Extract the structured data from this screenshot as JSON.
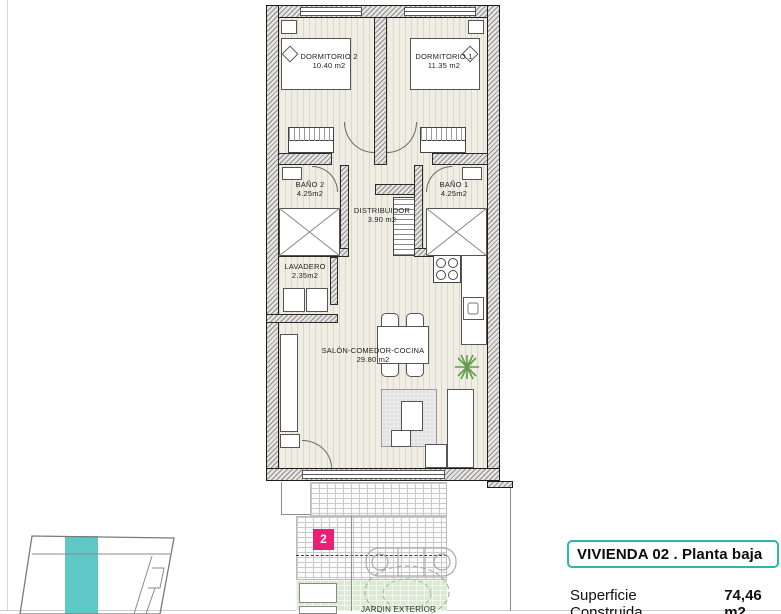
{
  "rooms": {
    "dormitorio2": {
      "name": "DORMITORIO 2",
      "area": "10.40 m2"
    },
    "dormitorio1": {
      "name": "DORMITORIO 1",
      "area": "11.35 m2"
    },
    "bano2": {
      "name": "BAÑO 2",
      "area": "4.25m2"
    },
    "bano1": {
      "name": "BAÑO 1",
      "area": "4.25m2"
    },
    "distribuidor": {
      "name": "DISTRIBUIDOR",
      "area": "3.90 m2"
    },
    "lavadero": {
      "name": "LAVADERO",
      "area": "2.35m2"
    },
    "salon": {
      "name": "SALÓN-COMEDOR-COCINA",
      "area": "29.80 m2"
    },
    "jardin": {
      "name": "JARDIN EXTERIOR"
    }
  },
  "badge": {
    "unit_number": "2"
  },
  "title_block": {
    "title": "VIVIENDA 02 .  Planta baja"
  },
  "surface": {
    "label": "Superficie Construida",
    "value": "74,46 m2"
  },
  "colors": {
    "accent_teal": "#2bb6b0",
    "badge_pink": "#ec1f78",
    "keyplan_highlight": "#5fc7c5",
    "garden_green": "#dcead5"
  }
}
